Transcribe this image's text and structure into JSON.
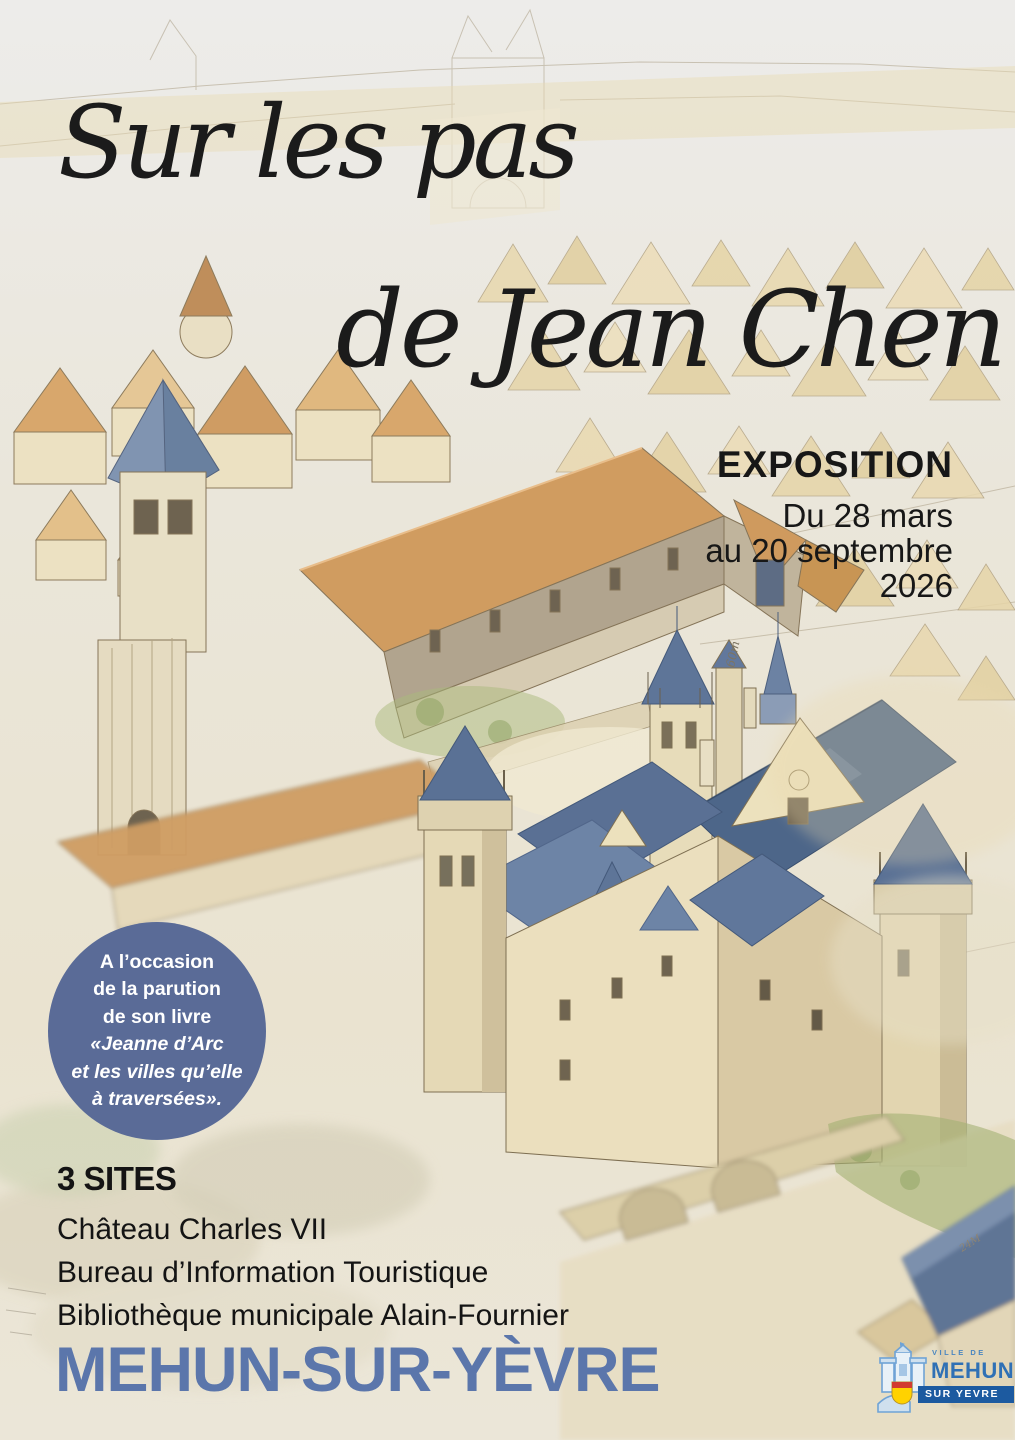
{
  "poster": {
    "title": {
      "line1": "Sur les pas",
      "line2": "de Jean Chen"
    },
    "event": {
      "kind": "EXPOSITION",
      "date_line1": "Du 28 mars",
      "date_line2": "au 20 septembre",
      "date_line3": "2026"
    },
    "book_badge": {
      "line1": "A l’occasion",
      "line2": "de la parution",
      "line3": "de son livre",
      "line4": "«Jeanne d’Arc",
      "line5": "et les villes qu’elle",
      "line6": "à traversées».",
      "background_color": "#5a6b97",
      "text_color": "#ffffff"
    },
    "sites": {
      "heading": "3 SITES",
      "site1": "Château Charles VII",
      "site2": "Bureau d’Information Touristique",
      "site3": "Bibliothèque municipale Alain-Fournier"
    },
    "city": {
      "name": "MEHUN-SUR-YÈVRE",
      "color": "#5b76ab"
    },
    "logo": {
      "top": "VILLE DE",
      "middle": "MEHUN",
      "banner": "SUR YEVRE"
    },
    "sketch_notes": {
      "keep_height": "60m",
      "bridge_note": "24M"
    }
  }
}
